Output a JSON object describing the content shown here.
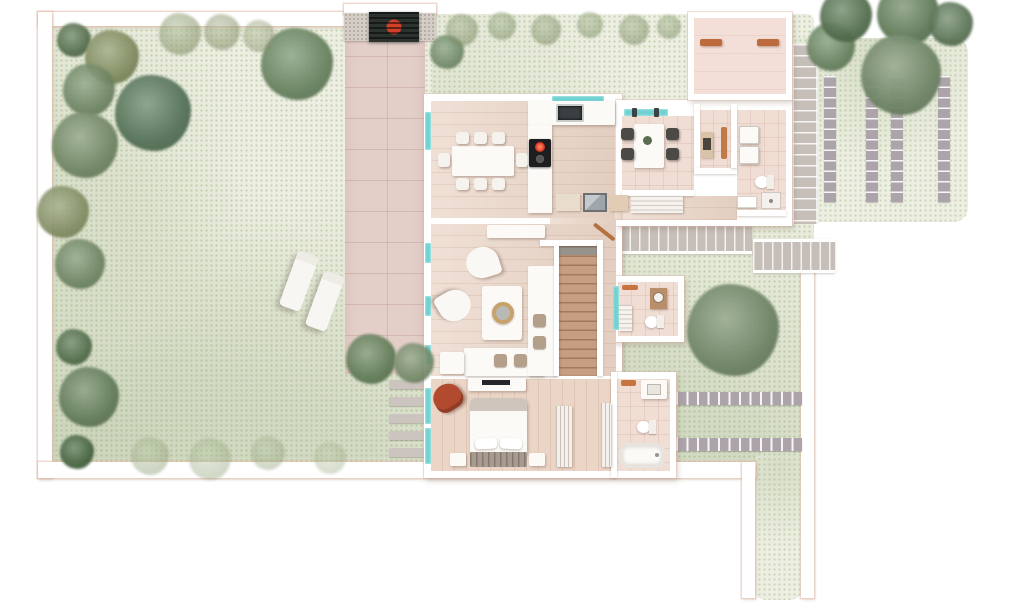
{
  "meta": {
    "type": "architectural-floor-plan",
    "view": "top-down ground-floor plan of a villa with garden, driveway, entry court and parking",
    "text_labels": []
  },
  "palette": {
    "page_bg": "#ffffff",
    "grass": "#edefe2",
    "grass_speckle": "#aab98c",
    "wall_outline": "#e4bead",
    "driveway": "#e3cec8",
    "wood_floor": "#ead5c7",
    "tile_floor": "#f0ddd4",
    "courtyard_floor": "#f3ded8",
    "window_glass": "#6fd2d2",
    "stair_wood": "#c69e81",
    "outdoor_step": "#c6bfb9",
    "paver": "#aca4aa",
    "path_step": "#ccc5bf",
    "gate_panel": "#2c332f",
    "gate_emblem": "#d2402a",
    "concrete": "#d5cec6",
    "cooktop": "#1e1e20",
    "burner_hot": "#cf2c1d",
    "sink_steel": "#3a3f42",
    "accent_chair": "#b14a2e",
    "bench_wood": "#bd6b3c",
    "headboard": "#a79b90",
    "fold_blanket": "#cfc5bc",
    "mirror": "#9fa6ab",
    "vanity_wood": "#b98e6b"
  },
  "garden": {
    "lounger_count": 2,
    "trees": [
      {
        "cx": 74,
        "cy": 40,
        "r": 17,
        "color": "#5f7b56",
        "op": 0.95
      },
      {
        "cx": 112,
        "cy": 57,
        "r": 27,
        "color": "#8d9a6a",
        "op": 0.95
      },
      {
        "cx": 89,
        "cy": 90,
        "r": 26,
        "color": "#76906a",
        "op": 0.9
      },
      {
        "cx": 85,
        "cy": 145,
        "r": 33,
        "color": "#7d9570",
        "op": 0.95
      },
      {
        "cx": 153,
        "cy": 113,
        "r": 38,
        "color": "#5e7e61",
        "op": 0.95
      },
      {
        "cx": 297,
        "cy": 64,
        "r": 36,
        "color": "#73906a",
        "op": 0.95
      },
      {
        "cx": 63,
        "cy": 212,
        "r": 26,
        "color": "#8c996a",
        "op": 0.9
      },
      {
        "cx": 80,
        "cy": 264,
        "r": 25,
        "color": "#76906a",
        "op": 0.9
      },
      {
        "cx": 74,
        "cy": 347,
        "r": 18,
        "color": "#54744c",
        "op": 0.9
      },
      {
        "cx": 89,
        "cy": 397,
        "r": 30,
        "color": "#6e8963",
        "op": 0.95
      },
      {
        "cx": 77,
        "cy": 452,
        "r": 17,
        "color": "#4e6f46",
        "op": 0.95
      },
      {
        "cx": 180,
        "cy": 34,
        "r": 21,
        "color": "#9cab7e",
        "op": 0.6
      },
      {
        "cx": 222,
        "cy": 32,
        "r": 18,
        "color": "#95a477",
        "op": 0.55
      },
      {
        "cx": 259,
        "cy": 36,
        "r": 16,
        "color": "#9cab7e",
        "op": 0.5
      },
      {
        "cx": 150,
        "cy": 456,
        "r": 19,
        "color": "#a4b789",
        "op": 0.45
      },
      {
        "cx": 210,
        "cy": 459,
        "r": 21,
        "color": "#a4b789",
        "op": 0.4
      },
      {
        "cx": 268,
        "cy": 453,
        "r": 17,
        "color": "#9db082",
        "op": 0.38
      },
      {
        "cx": 330,
        "cy": 458,
        "r": 16,
        "color": "#a4b789",
        "op": 0.35
      },
      {
        "cx": 371,
        "cy": 359,
        "r": 25,
        "color": "#6c8961",
        "op": 0.95
      },
      {
        "cx": 414,
        "cy": 363,
        "r": 20,
        "color": "#7d9570",
        "op": 0.9
      },
      {
        "cx": 447,
        "cy": 52,
        "r": 17,
        "color": "#73906a",
        "op": 0.85
      },
      {
        "cx": 462,
        "cy": 30,
        "r": 16,
        "color": "#8fa173",
        "op": 0.55
      },
      {
        "cx": 502,
        "cy": 26,
        "r": 14,
        "color": "#8aa06e",
        "op": 0.5
      },
      {
        "cx": 546,
        "cy": 30,
        "r": 15,
        "color": "#8fa173",
        "op": 0.55
      },
      {
        "cx": 590,
        "cy": 25,
        "r": 13,
        "color": "#8aa06e",
        "op": 0.5
      },
      {
        "cx": 634,
        "cy": 30,
        "r": 15,
        "color": "#8fa173",
        "op": 0.55
      },
      {
        "cx": 669,
        "cy": 27,
        "r": 12,
        "color": "#8aa06e",
        "op": 0.5
      },
      {
        "cx": 733,
        "cy": 330,
        "r": 46,
        "color": "#7a9270",
        "op": 0.95
      },
      {
        "cx": 831,
        "cy": 47,
        "r": 24,
        "color": "#73906a",
        "op": 0.95
      },
      {
        "cx": 846,
        "cy": 16,
        "r": 26,
        "color": "#5c7956",
        "op": 0.95
      },
      {
        "cx": 908,
        "cy": 14,
        "r": 31,
        "color": "#6a8660",
        "op": 0.95
      },
      {
        "cx": 951,
        "cy": 24,
        "r": 22,
        "color": "#5c7956",
        "op": 0.9
      },
      {
        "cx": 901,
        "cy": 75,
        "r": 40,
        "color": "#7a9270",
        "op": 0.95
      }
    ]
  },
  "hardscape": {
    "parking_strips": [
      {
        "x": 824,
        "y": 76,
        "w": 12,
        "h": 126
      },
      {
        "x": 866,
        "y": 76,
        "w": 12,
        "h": 126
      },
      {
        "x": 891,
        "y": 76,
        "w": 12,
        "h": 126
      },
      {
        "x": 938,
        "y": 76,
        "w": 12,
        "h": 126
      }
    ],
    "paver_rows": [
      {
        "x": 676,
        "y": 392,
        "w": 126,
        "h": 13
      },
      {
        "x": 676,
        "y": 438,
        "w": 126,
        "h": 13
      }
    ],
    "path_steps": [
      {
        "x": 389,
        "y": 380,
        "w": 43,
        "h": 9
      },
      {
        "x": 389,
        "y": 397,
        "w": 43,
        "h": 9
      },
      {
        "x": 389,
        "y": 414,
        "w": 43,
        "h": 9
      },
      {
        "x": 389,
        "y": 431,
        "w": 43,
        "h": 9
      },
      {
        "x": 389,
        "y": 448,
        "w": 43,
        "h": 9
      }
    ]
  },
  "house": {
    "rooms": [
      "entry-courtyard",
      "dining-room",
      "kitchen",
      "breakfast-room",
      "utility-room",
      "wc",
      "hallway",
      "living-room",
      "staircase",
      "guest-bathroom",
      "bedroom",
      "ensuite-bathroom"
    ],
    "furniture_counts": {
      "dining_chairs": 8,
      "breakfast_chairs": 4,
      "sun_loungers": 2,
      "armchairs": 3,
      "beds": 1
    }
  }
}
